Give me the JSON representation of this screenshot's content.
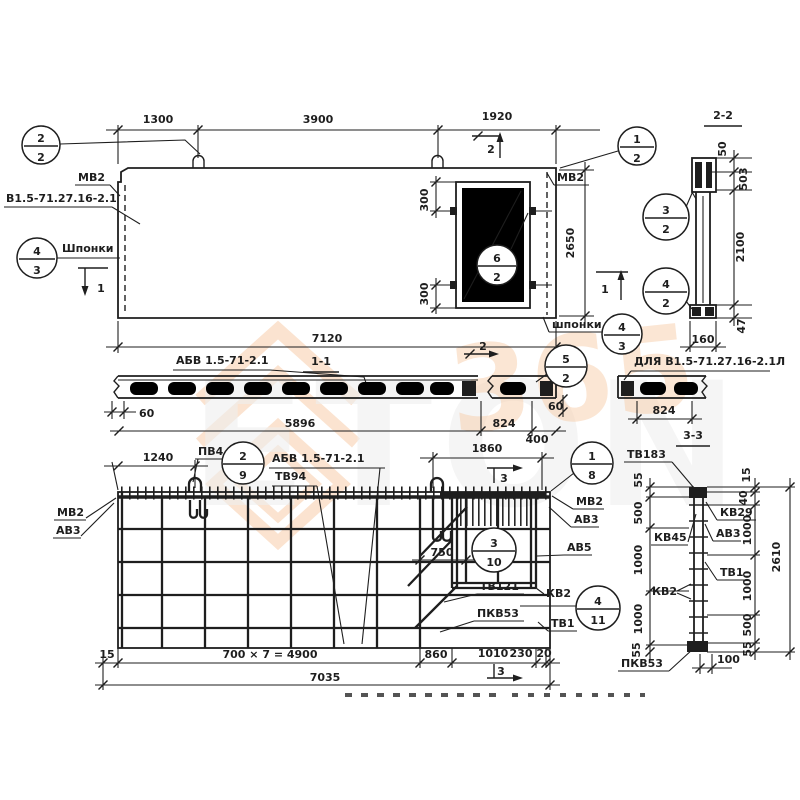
{
  "colors": {
    "ink": "#1e1e1e",
    "paper": "#ffffff",
    "watermark_orange": "#f0a465",
    "watermark_gray": "#e0e0e0"
  },
  "watermark": {
    "word": "ETON",
    "number": "365"
  },
  "top_plan": {
    "dims": {
      "left": "1300",
      "middle": "3900",
      "right": "1920",
      "total": "7120",
      "height": "2650",
      "opening_top": "300",
      "opening_bottom": "300"
    },
    "labels": {
      "mv2_left": "МВ2",
      "series_mark": "В1.5-71.27.16-2.1",
      "keys_left": "Шпонки",
      "mv2_right": "МВ2",
      "keys_right": "шпонки"
    },
    "section_marks": {
      "s1": "1",
      "s2": "2"
    },
    "callouts": {
      "loop": {
        "num": "2",
        "den": "2"
      },
      "keys_left": {
        "num": "4",
        "den": "3"
      },
      "opening": {
        "num": "6",
        "den": "2"
      },
      "corner": {
        "num": "1",
        "den": "2"
      },
      "keys_right": {
        "num": "4",
        "den": "3"
      }
    }
  },
  "section_2_2": {
    "title": "2-2",
    "dims": {
      "d50": "50",
      "d503": "503",
      "d2100": "2100",
      "d47": "47",
      "d160": "160"
    },
    "callouts": {
      "upper": {
        "num": "3",
        "den": "2"
      },
      "lower": {
        "num": "4",
        "den": "2"
      }
    }
  },
  "section_1_1": {
    "title": "1-1",
    "mesh_label": "АБВ 1.5-71-2.1",
    "variant_label": "ДЛЯ В1.5-71.27.16-2.1Л",
    "section_mark": "2",
    "callout": {
      "num": "5",
      "den": "2"
    },
    "dims": {
      "d60_left": "60",
      "d5896": "5896",
      "d824": "824",
      "d400": "400",
      "d60_right": "60",
      "d824_variant": "824"
    }
  },
  "bottom_plan": {
    "dims": {
      "d1240": "1240",
      "d1860": "1860",
      "d750": "750",
      "d15": "15",
      "d4900": "700 × 7 = 4900",
      "d860": "860",
      "d1010": "1010",
      "d230": "230",
      "d20": "20",
      "total": "7035"
    },
    "labels": {
      "pv4": "ПВ4",
      "mesh": "АБВ 1.5-71-2.1",
      "tv94": "ТВ94",
      "mv2_left": "МВ2",
      "av3_left": "АВ3",
      "mv2_right": "МВ2",
      "av3_right": "АВ3",
      "av5": "АВ5",
      "tv121": "ТВ121",
      "pkv53": "ПКВ53",
      "kv2": "КВ2",
      "tv1": "ТВ1"
    },
    "section_marks": {
      "s3": "3"
    },
    "callouts": {
      "loop": {
        "num": "2",
        "den": "9"
      },
      "corner": {
        "num": "1",
        "den": "8"
      },
      "mesh": {
        "num": "3",
        "den": "10"
      },
      "frame": {
        "num": "4",
        "den": "11"
      }
    }
  },
  "section_3_3": {
    "title": "3-3",
    "top_label": "ТВ183",
    "labels": {
      "kv29": "КВ29",
      "av3": "АВ3",
      "kv45": "КВ45",
      "tv1": "ТВ1",
      "kv2": "КВ2",
      "pkv53": "ПКВ53"
    },
    "dims": {
      "left": [
        "55",
        "500",
        "1000",
        "1000",
        "55"
      ],
      "right": [
        "15",
        "40",
        "1000",
        "1000",
        "500",
        "55"
      ],
      "total": "2610",
      "d100": "100"
    }
  }
}
